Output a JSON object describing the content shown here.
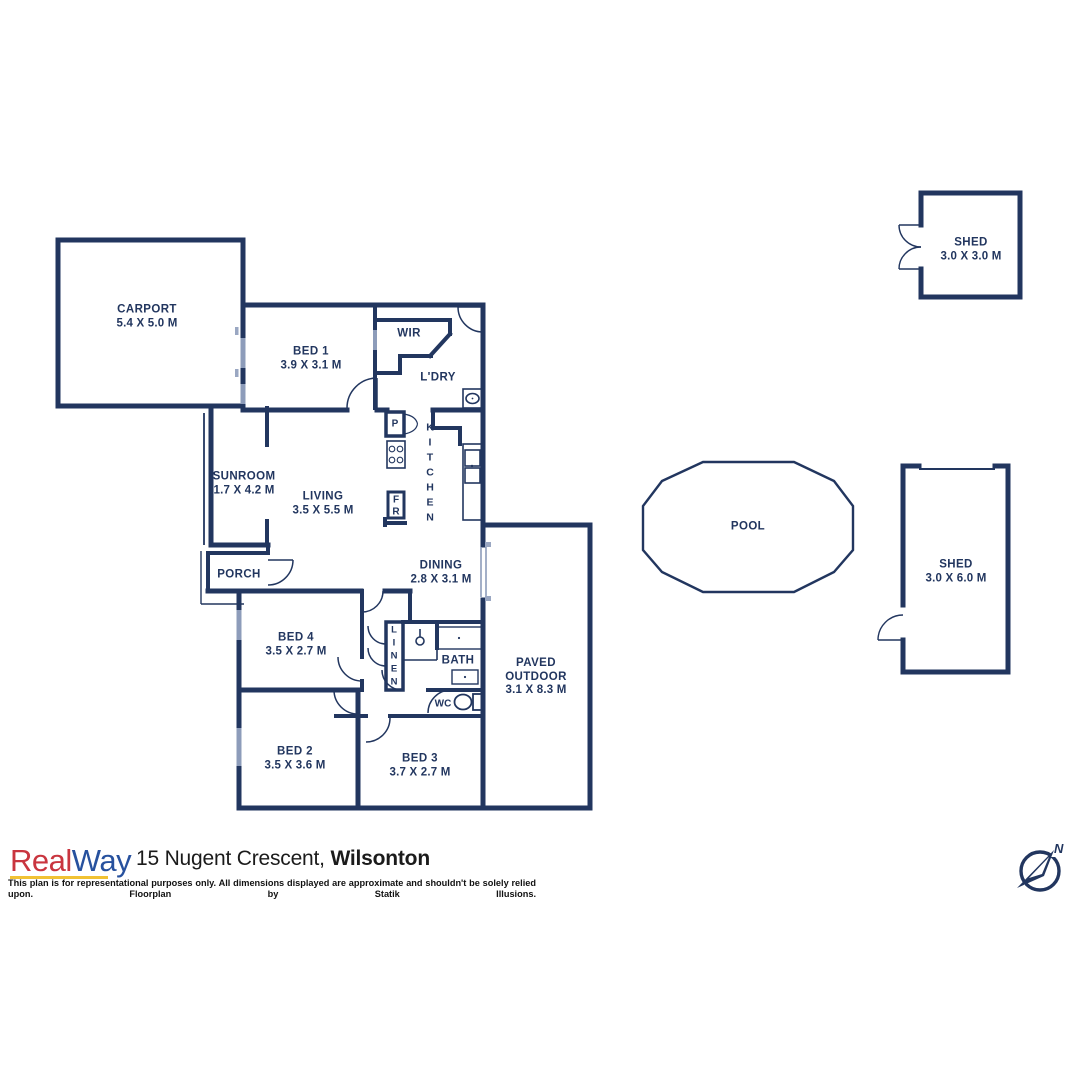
{
  "brand": {
    "real": "Real",
    "way": "Way"
  },
  "address": {
    "street": "15 Nugent Crescent,",
    "suburb": "Wilsonton"
  },
  "disclaimer": "This plan is for representational purposes only. All dimensions displayed are approximate and shouldn't be solely relied upon. Floorplan by Statik Illusions.",
  "compass": {
    "north_label": "N"
  },
  "colors": {
    "wall_navy": "#22365f",
    "window_grey": "#8d9cba",
    "brand_red": "#c9353f",
    "brand_blue": "#27519e",
    "underline_yellow": "#f1c233",
    "footer_text": "#121212"
  },
  "rooms": [
    {
      "id": "carport",
      "label": "CARPORT",
      "dims": "5.4 X 5.0 M"
    },
    {
      "id": "bed1",
      "label": "BED 1",
      "dims": "3.9 X 3.1 M"
    },
    {
      "id": "wir",
      "label": "WIR"
    },
    {
      "id": "ldry",
      "label": "L'DRY"
    },
    {
      "id": "sunroom",
      "label": "SUNROOM",
      "dims": "1.7 X 4.2 M"
    },
    {
      "id": "living",
      "label": "LIVING",
      "dims": "3.5 X 5.5 M"
    },
    {
      "id": "kitchen",
      "label": "KITCHEN"
    },
    {
      "id": "porch",
      "label": "PORCH"
    },
    {
      "id": "dining",
      "label": "DINING",
      "dims": "2.8 X 3.1 M"
    },
    {
      "id": "bed4",
      "label": "BED 4",
      "dims": "3.5 X 2.7 M"
    },
    {
      "id": "linen",
      "label": "LINEN"
    },
    {
      "id": "bath",
      "label": "BATH"
    },
    {
      "id": "wc",
      "label": "WC"
    },
    {
      "id": "bed2",
      "label": "BED 2",
      "dims": "3.5 X 3.6 M"
    },
    {
      "id": "bed3",
      "label": "BED 3",
      "dims": "3.7 X 2.7 M"
    },
    {
      "id": "paved_outdoor",
      "label": "PAVED",
      "label2": "OUTDOOR",
      "dims": "3.1 X 8.3 M"
    },
    {
      "id": "pool",
      "label": "POOL"
    },
    {
      "id": "shed_small",
      "label": "SHED",
      "dims": "3.0 X 3.0 M"
    },
    {
      "id": "shed_large",
      "label": "SHED",
      "dims": "3.0 X 6.0 M"
    }
  ],
  "appliances": {
    "pantry": "P",
    "fridge_top": "F",
    "fridge_bottom": "R"
  }
}
